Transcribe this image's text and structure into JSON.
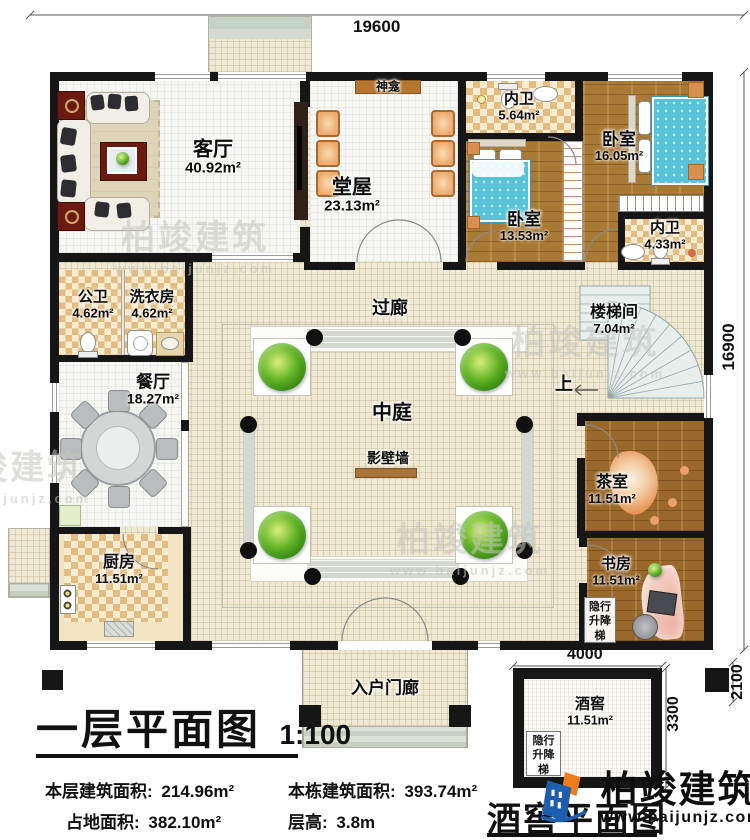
{
  "plan": {
    "dim_top": "19600",
    "dim_right": "16900",
    "cellar_dim_width": "4000",
    "cellar_dim_height": "3300",
    "cellar_dim_block": "2100"
  },
  "rooms": {
    "living": {
      "label": "客厅",
      "area": "40.92m²"
    },
    "shrine": {
      "label": "神龛"
    },
    "hall": {
      "label": "堂屋",
      "area": "23.13m²"
    },
    "bath_top": {
      "label": "内卫",
      "area": "5.64m²"
    },
    "bedroom_right": {
      "label": "卧室",
      "area": "16.05m²"
    },
    "bedroom_left": {
      "label": "卧室",
      "area": "13.53m²"
    },
    "bath_right": {
      "label": "内卫",
      "area": "4.33m²"
    },
    "public_bath": {
      "label": "公卫",
      "area": "4.62m²"
    },
    "laundry": {
      "label": "洗衣房",
      "area": "4.62m²"
    },
    "corridor": {
      "label": "过廊"
    },
    "stairwell": {
      "label": "楼梯间",
      "area": "7.04m²"
    },
    "up": {
      "label": "上"
    },
    "dining": {
      "label": "餐厅",
      "area": "18.27m²"
    },
    "atrium": {
      "label": "中庭"
    },
    "screen_wall": {
      "label": "影壁墙"
    },
    "tea_room": {
      "label": "茶室",
      "area": "11.51m²"
    },
    "kitchen": {
      "label": "厨房",
      "area": "11.51m²"
    },
    "study": {
      "label": "书房",
      "area": "11.51m²"
    },
    "study_elevator": {
      "label": "隐行升降梯"
    },
    "entry_porch": {
      "label": "入户门廊"
    },
    "cellar": {
      "label": "酒窖",
      "area": "11.51m²"
    },
    "cellar_elevator": {
      "label": "隐行升降梯"
    }
  },
  "titles": {
    "main": "一层平面图",
    "scale": "1:100",
    "cellar": "酒窖平面图"
  },
  "stats": {
    "floor_area_label": "本层建筑面积:",
    "floor_area_value": "214.96m²",
    "total_area_label": "本栋建筑面积:",
    "total_area_value": "393.74m²",
    "land_area_label": "占地面积:",
    "land_area_value": "382.10m²",
    "floor_height_label": "层高:",
    "floor_height_value": "3.8m"
  },
  "branding": {
    "name": "柏竣建筑",
    "url": "www.baijunjz.com"
  },
  "watermark": {
    "name": "柏竣建筑",
    "url": "www.baijunjz.com"
  }
}
